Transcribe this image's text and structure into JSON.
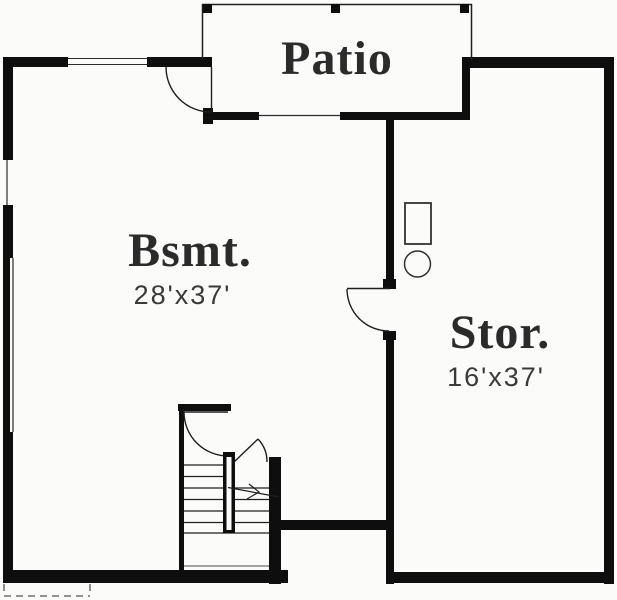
{
  "floor_plan": {
    "rooms": [
      {
        "name": "patio",
        "label": "Patio"
      },
      {
        "name": "basement",
        "label": "Bsmt.",
        "dimensions": "28'x37'"
      },
      {
        "name": "storage",
        "label": "Stor.",
        "dimensions": "16'x37'"
      }
    ],
    "colors": {
      "wall": "#0e0e0e",
      "linework": "#1f1f1f",
      "label_text": "#2b2b2b",
      "dimension_text": "#3a3a3a",
      "background": "#fbfbfa"
    }
  }
}
